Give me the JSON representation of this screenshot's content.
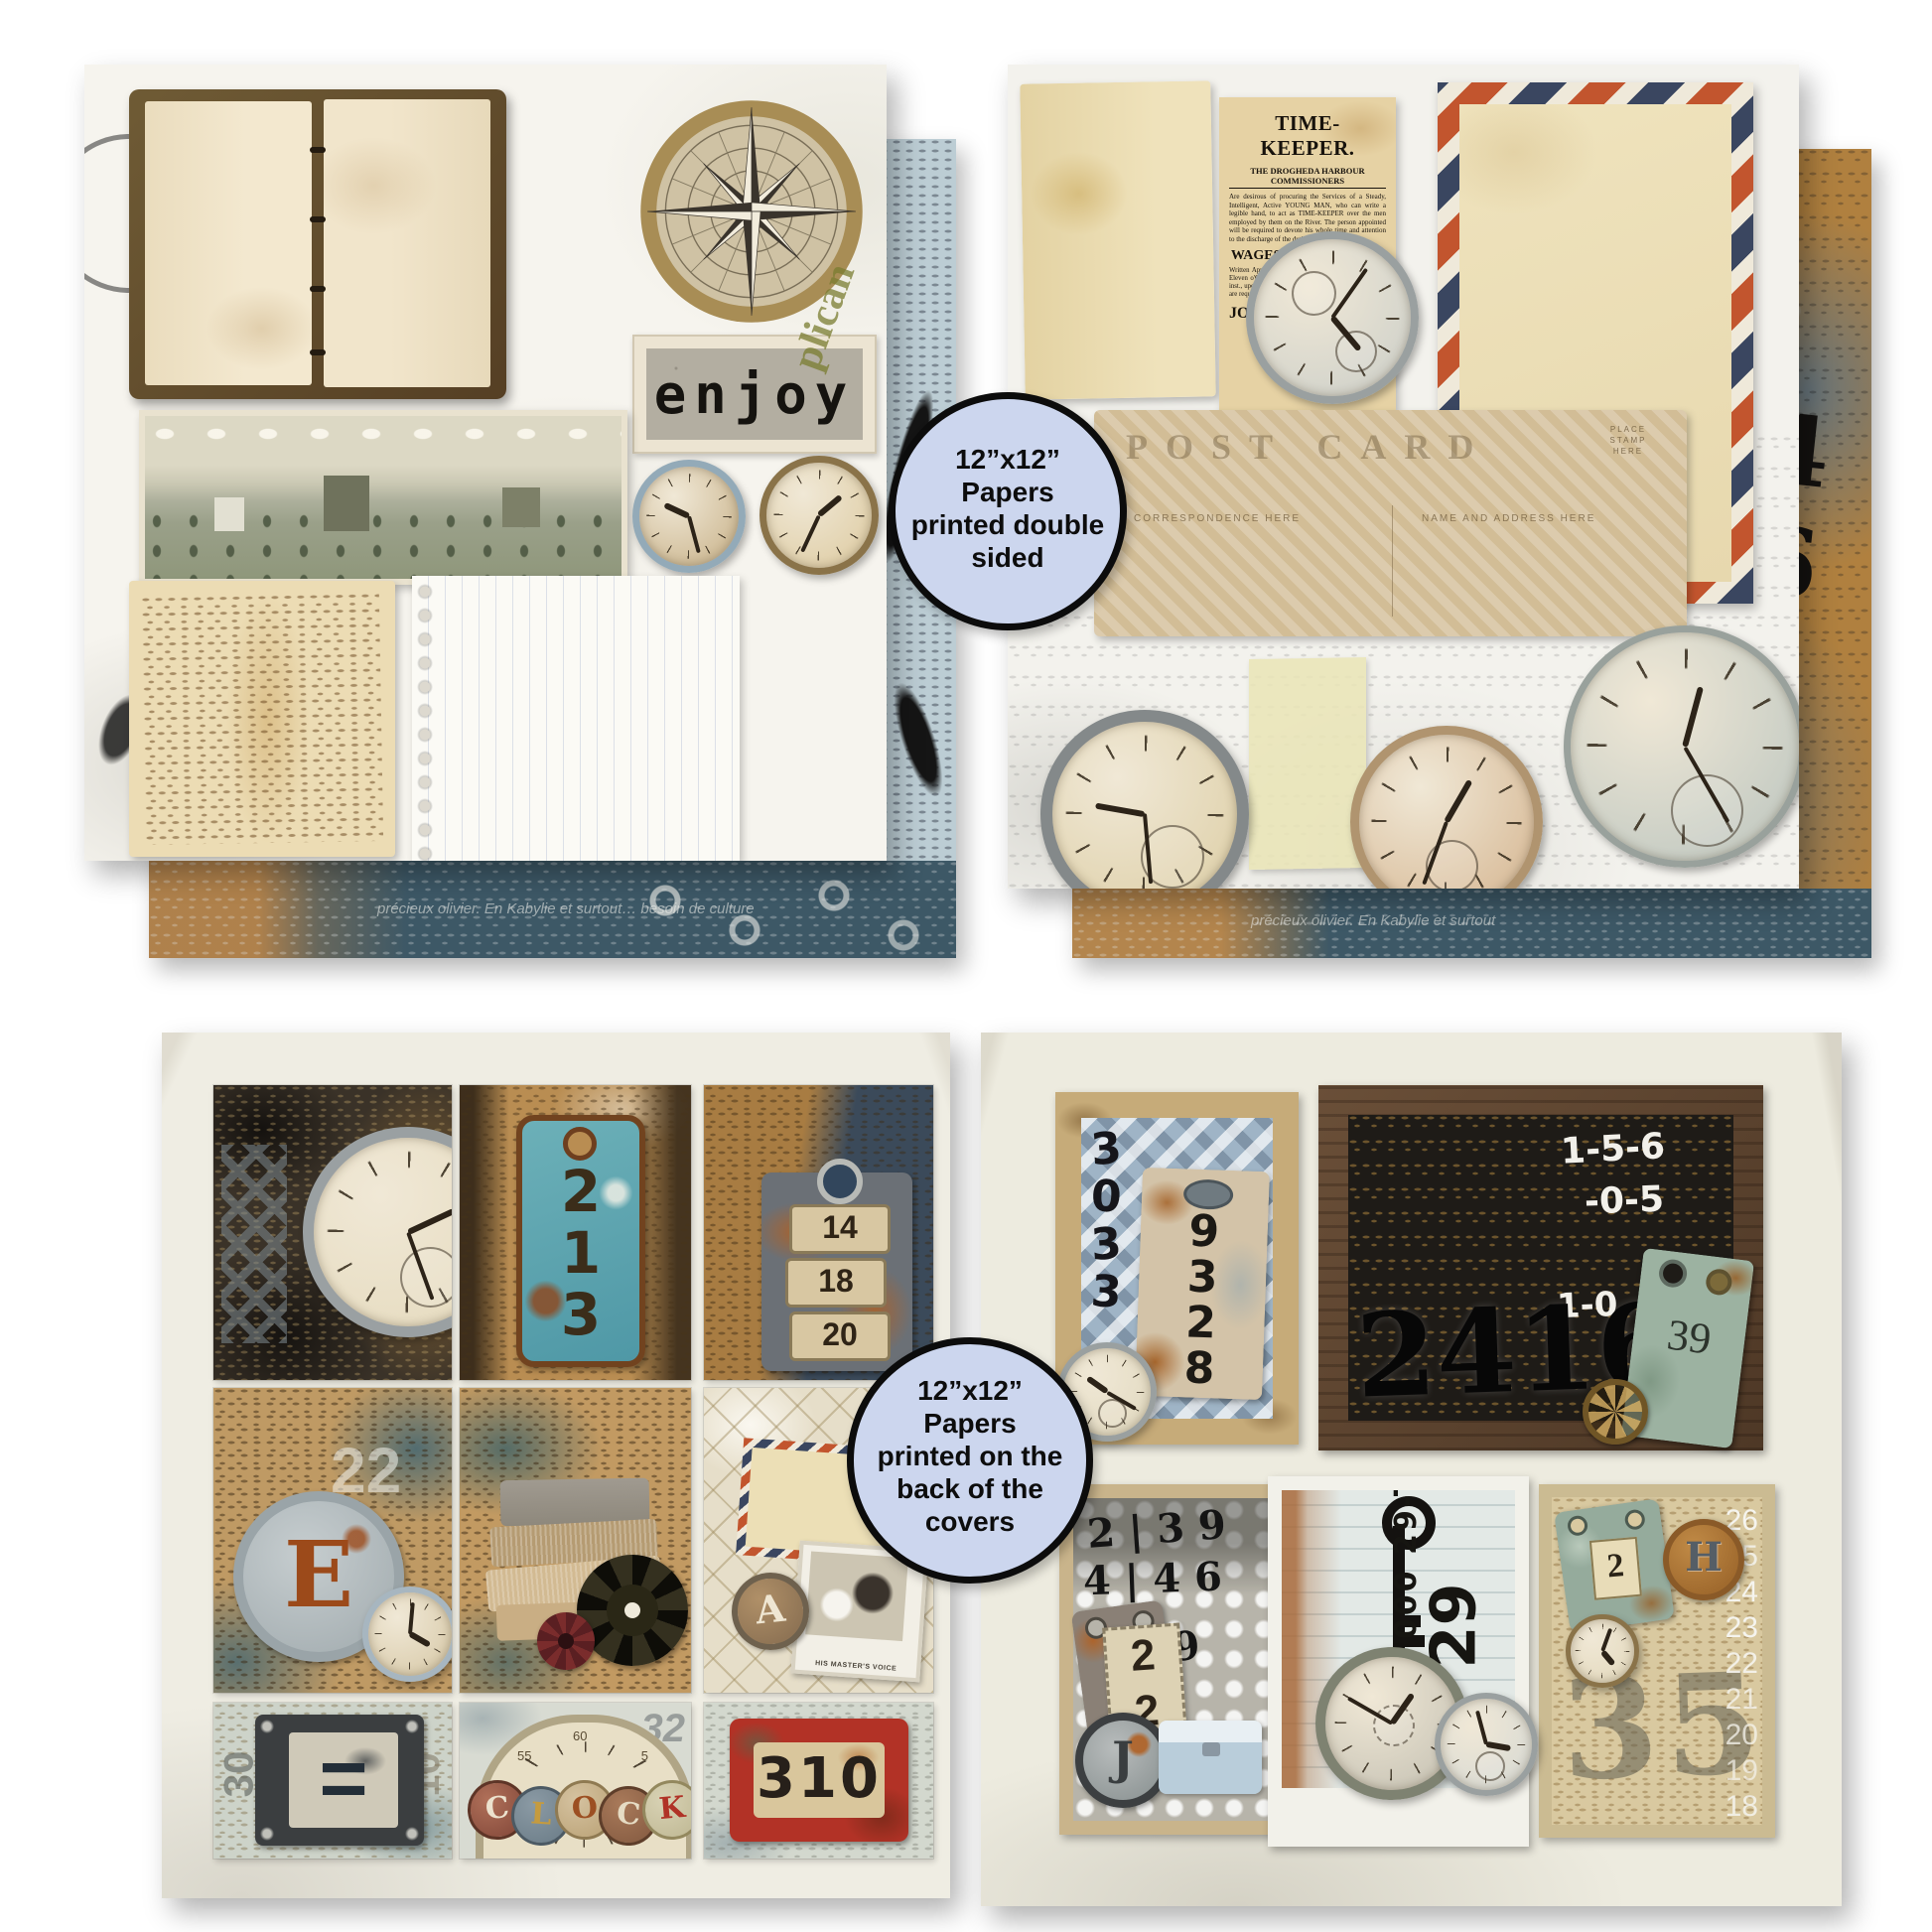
{
  "badge_top": {
    "lines": [
      "12”x12”",
      "Papers",
      "printed double",
      "sided"
    ]
  },
  "badge_bottom": {
    "lines": [
      "12”x12”",
      "Papers",
      "printed on the",
      "back of the",
      "covers"
    ]
  },
  "top_left": {
    "enjoy": "enjoy",
    "ghost_stamp": "plican",
    "strip_text": "précieux olivier. En Kabylie et surtout… besoin de culture"
  },
  "top_right": {
    "clipping": {
      "headline": "TIME-KEEPER.",
      "subhead": "THE DROGHEDA HARBOUR COMMISSIONERS",
      "body1": "Are desirous of procuring the Services of a Steady, Intelligent, Active YOUNG MAN, who can write a legible hand, to act as TIME-KEEPER over the men employed by them on the River. The person appointed will be required to devote his whole time and attention to the discharge of the duties.",
      "wages": "WAGES, 15s. per WEEK.",
      "body2": "Written Applications to be lodged with me at or before Eleven o'Clock in the forenoon of THURSDAY, the 9th inst., upon which day they will be considered. Applicants are required to be in attendance.",
      "sig_left": "JOHN",
      "sig_right": "Sec."
    },
    "postcard": {
      "title": "POST CARD",
      "left_label": "CORRESPONDENCE HERE",
      "right_label": "NAME AND ADDRESS HERE",
      "stamp_lines": [
        "PLACE",
        "STAMP",
        "HERE"
      ]
    },
    "backing_numbers": "4 6",
    "strip_text": "précieux olivier. En Kabylie et surtout"
  },
  "bottom_left": {
    "tag_213": [
      "2",
      "1",
      "3"
    ],
    "tag_plates": [
      "14",
      "18",
      "20"
    ],
    "letter_e": "E",
    "ghost_22": "22",
    "letter_a": "A",
    "card_caption": "HIS MASTER'S VOICE",
    "equals_sign": "=",
    "ghost_30": "30",
    "ghost_10": "10",
    "ghost_32": "32",
    "clock_letters": [
      "C",
      "L",
      "O",
      "C",
      "K"
    ],
    "arc_numbers": [
      "50",
      "55",
      "60",
      "5",
      "10"
    ],
    "plate_310": "310"
  },
  "bottom_right": {
    "frame_a": {
      "stencil": [
        "3",
        "0",
        "3",
        "3"
      ],
      "plate": [
        "9",
        "3",
        "2",
        "8"
      ]
    },
    "frame_b": {
      "chalk1": "1-5-6",
      "chalk2": "-0-5",
      "chalk3": "1-0",
      "big_number": "2416",
      "tag_number": "39"
    },
    "frame_c": {
      "row1": "2 | 3 9",
      "row2": "4 | 4 6",
      "row3": "2 9",
      "tag_digits": [
        "2",
        "2"
      ],
      "disc_letter": "J"
    },
    "frame_d": {
      "rotated_text": "000 29-T",
      "big_number": "29"
    },
    "frame_e": {
      "tag_number": "2",
      "disc_letter": "H",
      "ghost_number": "35",
      "side_numbers": [
        "26",
        "25",
        "24",
        "23",
        "22",
        "21",
        "20",
        "19",
        "18"
      ]
    }
  }
}
